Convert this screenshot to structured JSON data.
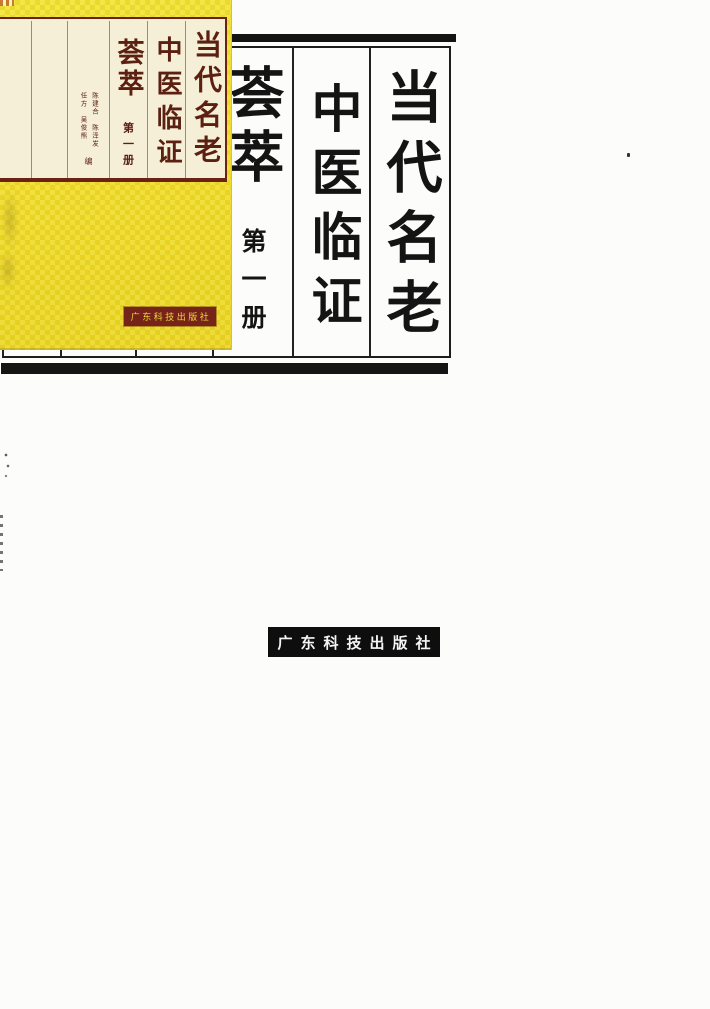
{
  "title_page": {
    "columns": [
      {
        "text": "当代名老"
      },
      {
        "text": "中医临证"
      },
      {
        "text": "荟萃"
      }
    ],
    "volume": "第一册",
    "publisher": "广东科技出版社",
    "colors": {
      "ink": "#141414",
      "paper": "#fcfcfa"
    }
  },
  "cover": {
    "columns": [
      {
        "text": "当代名老"
      },
      {
        "text": "中医临证"
      },
      {
        "text": "荟萃"
      }
    ],
    "volume": "第一册",
    "editors": {
      "left_column": "任方　吴俊熊",
      "right_column": "陈建合　陈泽发",
      "role": "编"
    },
    "publisher": "广东科技出版社",
    "colors": {
      "cover_yellow": "#eedb2c",
      "panel_cream": "#f6efd8",
      "frame_maroon": "#6b2113",
      "ink_maroon": "#5c2012",
      "publisher_bar_bg": "#76231a",
      "publisher_bar_text": "#f0d83a"
    }
  }
}
